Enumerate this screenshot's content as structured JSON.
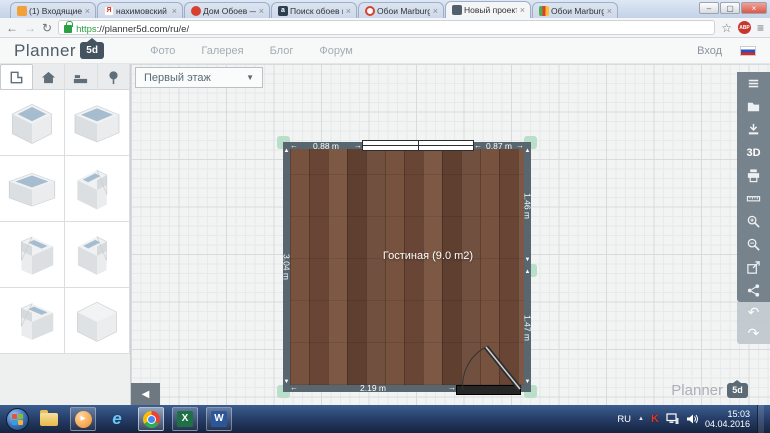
{
  "glyphs": {
    "arrow_left": "←",
    "arrow_right": "→",
    "arrow_up": "▲",
    "arrow_down": "▼",
    "caret_down": "▼",
    "collapse": "◀",
    "undo": "↶",
    "redo": "↷",
    "close": "×",
    "star": "☆",
    "menu": "≡",
    "back": "←",
    "forward": "→",
    "reload": "↻",
    "minimize": "–",
    "maximize": "▢",
    "tray_expand": "▲"
  },
  "browser": {
    "tabs": [
      {
        "title": "(1) Входящие - cheh"
      },
      {
        "title": "нахимовский просп"
      },
      {
        "title": "Дом Обоев — Мос"
      },
      {
        "title": "Поиск обоев по кра"
      },
      {
        "title": "Обои Marburg Chil"
      },
      {
        "title": "Новый проект - Pla"
      },
      {
        "title": "Обои Marburg Gloo"
      }
    ],
    "active_tab_index": 5,
    "url_scheme": "https",
    "url_rest": "://planner5d.com/ru/e/",
    "adblock_label": "ABP"
  },
  "header": {
    "logo_text": "Planner",
    "logo_badge": "5d",
    "nav": [
      {
        "label": "Фото"
      },
      {
        "label": "Галерея"
      },
      {
        "label": "Блог"
      },
      {
        "label": "Форум"
      }
    ],
    "login_label": "Вход"
  },
  "plan_toolbar": {
    "floor_selector_value": "Первый этаж"
  },
  "sidebar": {
    "tabs": [
      "room-shapes",
      "construction",
      "furniture",
      "outdoor"
    ],
    "shapes": [
      "square-room",
      "rectangle-room",
      "wide-room",
      "l-room-notch-right",
      "l-room-notch-front",
      "l-room-notch-left",
      "l-room-step",
      "solid-cube"
    ]
  },
  "canvas": {
    "room": {
      "label": "Гостиная (9.0 m2)",
      "dim_top_left": "0.88 m",
      "dim_top_right": "0.87 m",
      "dim_left": "3.04 m",
      "dim_right_top": "1.46 m",
      "dim_right_bottom": "1.47 m",
      "dim_bottom": "2.19 m"
    },
    "watermark_text": "Planner",
    "watermark_badge": "5d"
  },
  "right_toolbar": {
    "label_3d": "3D",
    "items": [
      "menu",
      "projects",
      "save",
      "3d-view",
      "print",
      "measure",
      "zoom-in",
      "zoom-out",
      "fullscreen",
      "share",
      "undo",
      "redo"
    ]
  },
  "taskbar": {
    "wmp_glyph": "▸",
    "ie_glyph": "e",
    "excel_glyph": "X",
    "word_glyph": "W",
    "tray": {
      "lang": "RU",
      "kaspersky": "K",
      "time": "15:03",
      "date": "04.04.2016"
    }
  },
  "colors": {
    "wall": "#57666f",
    "floor": "#6f4b38",
    "handle": "#b9dfca",
    "right_toolbar_bg": "#76838d",
    "taskbar_top": "#3c5e8f"
  }
}
